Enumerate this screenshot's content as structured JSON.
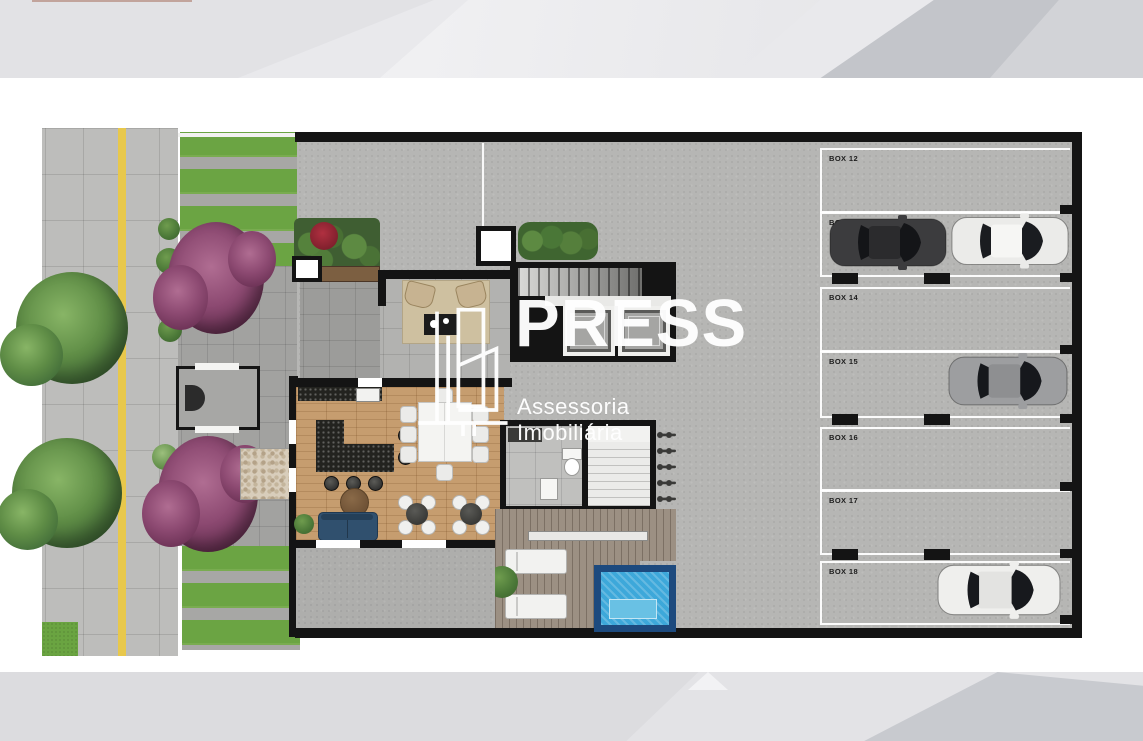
{
  "watermark": {
    "brand": "PRESS",
    "tagline": "Assessoria Imobiliária",
    "logo_icon": "buildings-outline-icon",
    "color": "#ffffff"
  },
  "parking": {
    "boxes": [
      {
        "label": "BOX 12"
      },
      {
        "label": "BOX 13"
      },
      {
        "label": "BOX 14"
      },
      {
        "label": "BOX 15"
      },
      {
        "label": "BOX 16"
      },
      {
        "label": "BOX 17"
      },
      {
        "label": "BOX 18"
      }
    ],
    "cars": [
      {
        "name": "dark-suv",
        "box": "BOX 13",
        "body": "#3c3c3e",
        "roof": "#2b2b2d",
        "glass": "#141518"
      },
      {
        "name": "white-sedan",
        "box": "BOX 13",
        "body": "#ebebe9",
        "roof": "#f6f6f4",
        "glass": "#1a1c20"
      },
      {
        "name": "silver-sedan",
        "box": "BOX 15",
        "body": "#9d9ea0",
        "roof": "#8e8f91",
        "glass": "#16181c"
      },
      {
        "name": "white-suv",
        "box": "BOX 18",
        "body": "#efefed",
        "roof": "#e3e3e1",
        "glass": "#17191d"
      }
    ]
  },
  "palette": {
    "pool_water": "#3da8da",
    "pool_tile": "#1d4a7e",
    "lawn_green": "#6ba443",
    "shrub_purple": "#8d4a72",
    "wood_floor": "#c69d6f",
    "deck_wood": "#9c9083",
    "wall_black": "#141414",
    "pavement_gray": "#bdbdbb",
    "tactile_yellow": "#e8c84c",
    "sofa_blue": "#30506e",
    "banner_gray": "#e9e9ec"
  }
}
